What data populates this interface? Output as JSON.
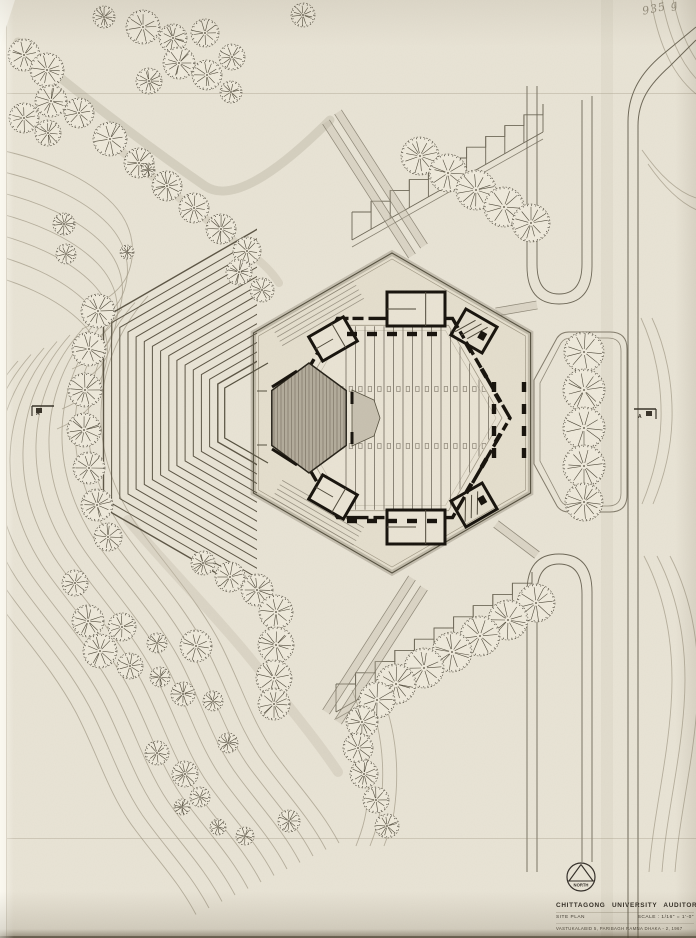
{
  "annotation": {
    "pencil_note": "935 g"
  },
  "section_markers": {
    "left_label": "A",
    "right_label": "A"
  },
  "title_block": {
    "north_label": "NORTH",
    "project_title": "CHITTAGONG UNIVERSITY AUDITORIUM",
    "drawing_name": "SITE PLAN",
    "scale_label": "SCALE : 1/16\" = 1'-0\"",
    "credit_line": "VASTUKALABID   5, PARIBAGH   RAMNA   DHAKA - 2,   1967"
  },
  "drawing": {
    "colors": {
      "paper": "#e9e4d6",
      "ink": "#262219",
      "ink_soft": "#4e4839",
      "wall_black": "#17130d",
      "line": "#6e6858",
      "faint": "#a29a87",
      "soft": "#c2bbaa",
      "tree_fill": "#efeadc",
      "court_fill": "#e4decd",
      "hall_fill": "#eae4d5",
      "stage_fill": "#b3ac9c",
      "stage_hatch": "#857e6f",
      "apron_fill": "#c8c1b1"
    },
    "court": {
      "cx": 392,
      "cy": 413,
      "r": 160
    },
    "hall": {
      "cx": 395,
      "cy": 418,
      "r": 115
    },
    "stage": {
      "cx": 309,
      "cy": 418,
      "rx": 43,
      "ry": 55
    },
    "fan": {
      "cx": 268,
      "cy": 413,
      "rMin": 58,
      "rMax": 190,
      "rings": 15,
      "clipX": 257
    },
    "platform": {
      "cx": 268,
      "cy": 413,
      "r": 50
    },
    "seats": {
      "x0": 346,
      "x1": 489,
      "step": 9.5,
      "clipR": 106,
      "tickRows": [
        389,
        446
      ]
    },
    "rooms": [
      [
        416,
        309,
        58,
        34,
        0
      ],
      [
        416,
        527,
        58,
        34,
        0
      ],
      [
        333,
        339,
        40,
        28,
        -30
      ],
      [
        333,
        497,
        40,
        28,
        30
      ]
    ],
    "pavilions": [
      [
        474,
        331,
        36,
        30,
        30
      ],
      [
        474,
        505,
        36,
        30,
        -30
      ]
    ],
    "dashes": [
      [
        352,
        334,
        0
      ],
      [
        372,
        334,
        0
      ],
      [
        392,
        334,
        0
      ],
      [
        412,
        334,
        0
      ],
      [
        432,
        334,
        0
      ],
      [
        352,
        521,
        0
      ],
      [
        372,
        521,
        0
      ],
      [
        392,
        521,
        0
      ],
      [
        412,
        521,
        0
      ],
      [
        432,
        521,
        0
      ],
      [
        469,
        348,
        60
      ],
      [
        484,
        373,
        60
      ],
      [
        498,
        398,
        60
      ],
      [
        469,
        488,
        -60
      ],
      [
        484,
        463,
        -60
      ],
      [
        498,
        438,
        -60
      ],
      [
        494,
        387,
        90
      ],
      [
        494,
        409,
        90
      ],
      [
        494,
        431,
        90
      ],
      [
        494,
        453,
        90
      ],
      [
        524,
        387,
        90
      ],
      [
        524,
        409,
        90
      ],
      [
        524,
        431,
        90
      ],
      [
        524,
        453,
        90
      ]
    ],
    "trees": [
      [
        303,
        15,
        12
      ],
      [
        143,
        27,
        17
      ],
      [
        173,
        38,
        14
      ],
      [
        205,
        33,
        14
      ],
      [
        232,
        57,
        13
      ],
      [
        179,
        63,
        16
      ],
      [
        207,
        75,
        15
      ],
      [
        149,
        81,
        13
      ],
      [
        231,
        92,
        11
      ],
      [
        104,
        17,
        11
      ],
      [
        24,
        55,
        16
      ],
      [
        47,
        70,
        17
      ],
      [
        24,
        118,
        15
      ],
      [
        51,
        101,
        16
      ],
      [
        79,
        113,
        15
      ],
      [
        48,
        133,
        13
      ],
      [
        110,
        139,
        17
      ],
      [
        139,
        163,
        15
      ],
      [
        167,
        186,
        15
      ],
      [
        194,
        208,
        15
      ],
      [
        221,
        229,
        15
      ],
      [
        247,
        251,
        14
      ],
      [
        239,
        272,
        13
      ],
      [
        262,
        290,
        12
      ],
      [
        148,
        170,
        7
      ],
      [
        127,
        252,
        7
      ],
      [
        64,
        224,
        11
      ],
      [
        66,
        254,
        10
      ],
      [
        98,
        311,
        17
      ],
      [
        89,
        349,
        17
      ],
      [
        85,
        390,
        17
      ],
      [
        84,
        430,
        17
      ],
      [
        89,
        468,
        16
      ],
      [
        97,
        505,
        16
      ],
      [
        108,
        537,
        14
      ],
      [
        420,
        156,
        19
      ],
      [
        448,
        173,
        19
      ],
      [
        476,
        190,
        20
      ],
      [
        504,
        207,
        20
      ],
      [
        531,
        223,
        19
      ],
      [
        584,
        352,
        20
      ],
      [
        584,
        390,
        21
      ],
      [
        584,
        428,
        21
      ],
      [
        584,
        466,
        21
      ],
      [
        584,
        502,
        19
      ],
      [
        536,
        603,
        19
      ],
      [
        508,
        620,
        20
      ],
      [
        480,
        636,
        20
      ],
      [
        452,
        652,
        20
      ],
      [
        424,
        668,
        20
      ],
      [
        396,
        684,
        20
      ],
      [
        377,
        700,
        18
      ],
      [
        362,
        722,
        16
      ],
      [
        358,
        748,
        15
      ],
      [
        364,
        774,
        14
      ],
      [
        376,
        800,
        13
      ],
      [
        387,
        826,
        12
      ],
      [
        203,
        563,
        12
      ],
      [
        230,
        577,
        15
      ],
      [
        257,
        590,
        16
      ],
      [
        276,
        612,
        17
      ],
      [
        276,
        645,
        18
      ],
      [
        274,
        678,
        18
      ],
      [
        274,
        704,
        16
      ],
      [
        75,
        583,
        13
      ],
      [
        88,
        621,
        16
      ],
      [
        122,
        627,
        14
      ],
      [
        100,
        651,
        17
      ],
      [
        130,
        666,
        13
      ],
      [
        160,
        677,
        10
      ],
      [
        157,
        643,
        10
      ],
      [
        196,
        646,
        16
      ],
      [
        183,
        694,
        12
      ],
      [
        213,
        701,
        10
      ],
      [
        228,
        743,
        10
      ],
      [
        157,
        753,
        12
      ],
      [
        185,
        774,
        13
      ],
      [
        200,
        797,
        10
      ],
      [
        182,
        807,
        8
      ],
      [
        218,
        827,
        8
      ],
      [
        289,
        821,
        11
      ],
      [
        245,
        836,
        9
      ]
    ],
    "contours": [
      {
        "d": "M148,296 C118,330 102,370 101,412 C100,456 116,497 141,531 C168,568 197,600 219,641 C241,683 252,724 278,758 C301,789 322,811 339,843",
        "n": 12,
        "dx": -13,
        "dy": 6.5
      },
      {
        "d": "M0,150 C46,160 88,178 113,204 C131,223 137,247 129,271 C123,289 106,301 87,309",
        "n": 7,
        "dx": -5,
        "dy": 20
      },
      {
        "d": "M651,0 C657,36 669,72 696,94",
        "n": 3,
        "dx": 10,
        "dy": -6
      },
      {
        "d": "M642,150 C660,176 678,192 696,198",
        "n": 2,
        "dx": 6,
        "dy": 14
      },
      {
        "d": "M641,318 C655,348 662,384 661,420 C660,452 652,480 642,504",
        "n": 2,
        "dx": 11,
        "dy": 0
      },
      {
        "d": "M644,556 C667,600 675,652 671,706 C667,764 653,818 649,872",
        "n": 3,
        "dx": 13,
        "dy": 0
      },
      {
        "d": "M352,690 C368,728 372,770 366,812 C363,830 358,840 356,846",
        "n": 3,
        "dx": 14,
        "dy": 0
      }
    ],
    "softPaths": [
      {
        "d": "M18,42 C70,88 150,148 205,186 C235,206 288,162 330,120",
        "w": 9,
        "o": 0.5
      },
      {
        "d": "M108,140 C150,175 200,215 248,252 C263,263 272,272 279,283",
        "w": 8,
        "o": 0.4
      },
      {
        "d": "M128,520 C170,570 220,620 258,668 C290,708 318,742 338,772",
        "w": 10,
        "o": 0.35
      },
      {
        "d": "M607,0 L607,938",
        "w": 12,
        "o": 0.16
      }
    ],
    "roadLines": [
      "M628,938 L628,122 C628,92 642,72 662,55 L696,27",
      "M638,938 L638,126 C638,100 650,84 670,66 L696,40"
    ],
    "loops": [
      "M527,86 L527,266 Q527,304 559,304 Q592,304 592,266 L592,96",
      "M537,86 L537,264 Q537,294 559,294 Q582,294 582,264 L582,100",
      "M527,872 L527,592 Q527,554 559,554 Q592,554 592,592 L592,862",
      "M537,872 L537,594 Q537,564 559,564 Q582,564 582,594 L582,862"
    ],
    "bands": [
      [
        326,
        122,
        412,
        256
      ],
      [
        338,
        112,
        424,
        246
      ],
      [
        326,
        712,
        412,
        578
      ],
      [
        338,
        722,
        424,
        588
      ],
      [
        496,
        312,
        537,
        305
      ],
      [
        496,
        524,
        537,
        555
      ]
    ],
    "combs": [
      {
        "x0": 352,
        "y0": 240,
        "x1": 543,
        "y1": 132,
        "n": 11,
        "len": 28
      },
      {
        "x0": 336,
        "y0": 712,
        "x1": 532,
        "y1": 600,
        "n": 11,
        "len": 28
      }
    ],
    "island": {
      "d1": "M534,380 L534,464 L557,506 Q561,512 569,512 L610,512 Q627,512 627,495 L627,349 Q627,332 610,332 L569,332 Q561,332 557,338 Z",
      "d2": "M540,383 L540,461 L561,501 Q564,506 571,506 L608,506 Q621,506 621,493 L621,351 Q621,338 608,338 L571,338 Q564,338 561,343 Z"
    }
  }
}
